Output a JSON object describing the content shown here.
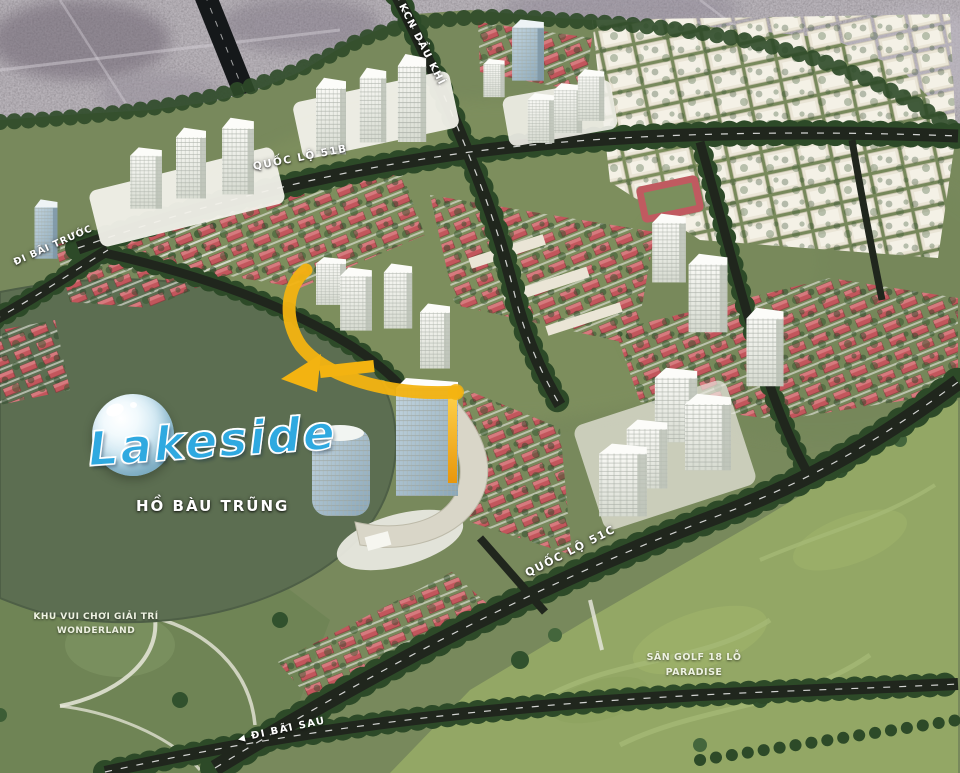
{
  "map": {
    "logo_text": "Lakeside",
    "lake_label": "HỒ BÀU TRŨNG",
    "roads": {
      "r51b": "QUỐC LỘ 51B",
      "r51c": "QUỐC LỘ 51C",
      "dau_khi": "KCN DẦU KHÍ",
      "bai_truoc": "ĐI BÃI TRƯỚC",
      "bai_sau": "ĐI BÃI SAU",
      "bai_sau_arrow": "◀"
    },
    "areas": {
      "wonderland_l1": "KHU VUI CHƠI GIẢI TRÍ",
      "wonderland_l2": "WONDERLAND",
      "golf_l1": "SÂN GOLF 18 LỖ",
      "golf_l2": "PARADISE"
    },
    "colors": {
      "logo_blue": "#2fa9e0",
      "highlight_yellow": "#f3b311",
      "roof_red": "#c2565c",
      "lake_green": "#5c6e51",
      "road_dark": "#20261d",
      "golf_green": "#93a765",
      "park_green": "#6f8455",
      "city_photo_gray": "#a59da7"
    }
  }
}
